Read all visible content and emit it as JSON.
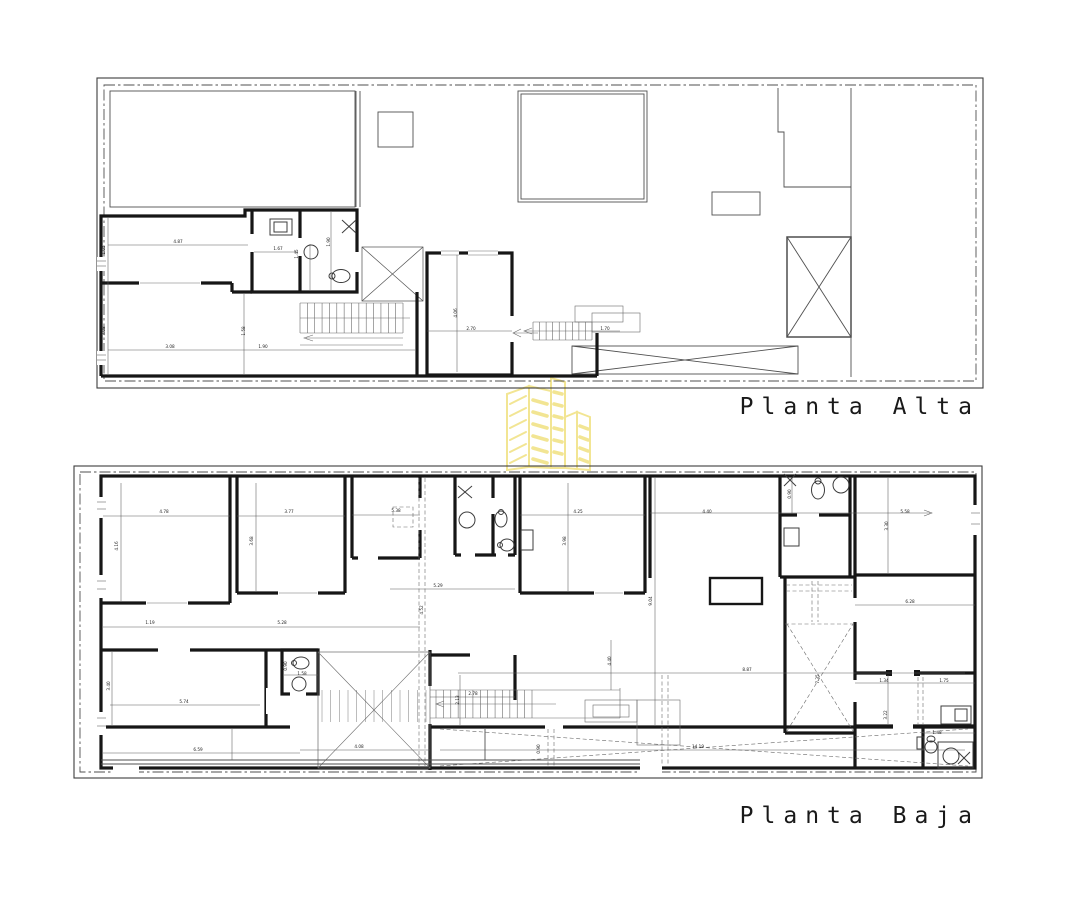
{
  "document": {
    "type": "architectural-floor-plans",
    "background": "#ffffff"
  },
  "plans": [
    {
      "id": "alta",
      "title": "Planta Alta"
    },
    {
      "id": "baja",
      "title": "Planta Baja"
    }
  ],
  "watermark": {
    "icon": "buildings-logo",
    "color": "#F2E48E"
  },
  "line_colors": {
    "walls": "#161616",
    "thin_lines": "#4f4f4f",
    "dimensions": "#5a5a5a",
    "boundary": "#3d3d3d"
  },
  "annotations": {
    "alta": [
      {
        "t": "4.87",
        "x": 178,
        "y": 243
      },
      {
        "t": "1.05",
        "x": 105,
        "y": 250,
        "r": -90
      },
      {
        "t": "3.08",
        "x": 105,
        "y": 331,
        "r": -90
      },
      {
        "t": "3.08",
        "x": 170,
        "y": 348
      },
      {
        "t": "1.58",
        "x": 245,
        "y": 331,
        "r": -90
      },
      {
        "t": "1.90",
        "x": 263,
        "y": 348
      },
      {
        "t": "1.67",
        "x": 278,
        "y": 250
      },
      {
        "t": "1.45",
        "x": 298,
        "y": 254,
        "r": -90
      },
      {
        "t": "1.90",
        "x": 330,
        "y": 242,
        "r": -90
      },
      {
        "t": "2.70",
        "x": 471,
        "y": 330
      },
      {
        "t": "4.06",
        "x": 457,
        "y": 313,
        "r": -90
      },
      {
        "t": "1.70",
        "x": 605,
        "y": 330
      }
    ],
    "baja": [
      {
        "t": "4.78",
        "x": 164,
        "y": 513
      },
      {
        "t": "4.16",
        "x": 118,
        "y": 546,
        "r": -90
      },
      {
        "t": "3.77",
        "x": 289,
        "y": 513
      },
      {
        "t": "3.68",
        "x": 253,
        "y": 541,
        "r": -90
      },
      {
        "t": "5.38",
        "x": 396,
        "y": 512
      },
      {
        "t": "1.19",
        "x": 150,
        "y": 624
      },
      {
        "t": "5.28",
        "x": 282,
        "y": 624
      },
      {
        "t": "5.29",
        "x": 438,
        "y": 587
      },
      {
        "t": "4.52",
        "x": 423,
        "y": 610,
        "r": -90
      },
      {
        "t": "4.25",
        "x": 578,
        "y": 513
      },
      {
        "t": "3.98",
        "x": 566,
        "y": 541,
        "r": -90
      },
      {
        "t": "4.40",
        "x": 707,
        "y": 513
      },
      {
        "t": "5.58",
        "x": 905,
        "y": 513
      },
      {
        "t": "9.04",
        "x": 652,
        "y": 601,
        "r": -90
      },
      {
        "t": "8.87",
        "x": 747,
        "y": 671
      },
      {
        "t": "2.78",
        "x": 473,
        "y": 695
      },
      {
        "t": "2.13",
        "x": 459,
        "y": 700,
        "r": -90
      },
      {
        "t": "4.40",
        "x": 611,
        "y": 661,
        "r": -90
      },
      {
        "t": "7.35",
        "x": 819,
        "y": 679,
        "r": -90
      },
      {
        "t": "3.30",
        "x": 888,
        "y": 526,
        "r": -90
      },
      {
        "t": "6.28",
        "x": 910,
        "y": 603
      },
      {
        "t": "1.34",
        "x": 884,
        "y": 682
      },
      {
        "t": "1.75",
        "x": 944,
        "y": 682
      },
      {
        "t": "3.22",
        "x": 887,
        "y": 715,
        "r": -90
      },
      {
        "t": "1.48",
        "x": 937,
        "y": 734
      },
      {
        "t": "0.90",
        "x": 791,
        "y": 494,
        "r": -90
      },
      {
        "t": "5.74",
        "x": 184,
        "y": 703
      },
      {
        "t": "3.40",
        "x": 110,
        "y": 686,
        "r": -90
      },
      {
        "t": "0.90",
        "x": 287,
        "y": 666,
        "r": -90
      },
      {
        "t": "1.58",
        "x": 302,
        "y": 675
      },
      {
        "t": "6.59",
        "x": 198,
        "y": 751
      },
      {
        "t": "4.08",
        "x": 359,
        "y": 748
      },
      {
        "t": "14.19",
        "x": 698,
        "y": 748
      },
      {
        "t": "0.90",
        "x": 540,
        "y": 749,
        "r": -90
      }
    ]
  }
}
